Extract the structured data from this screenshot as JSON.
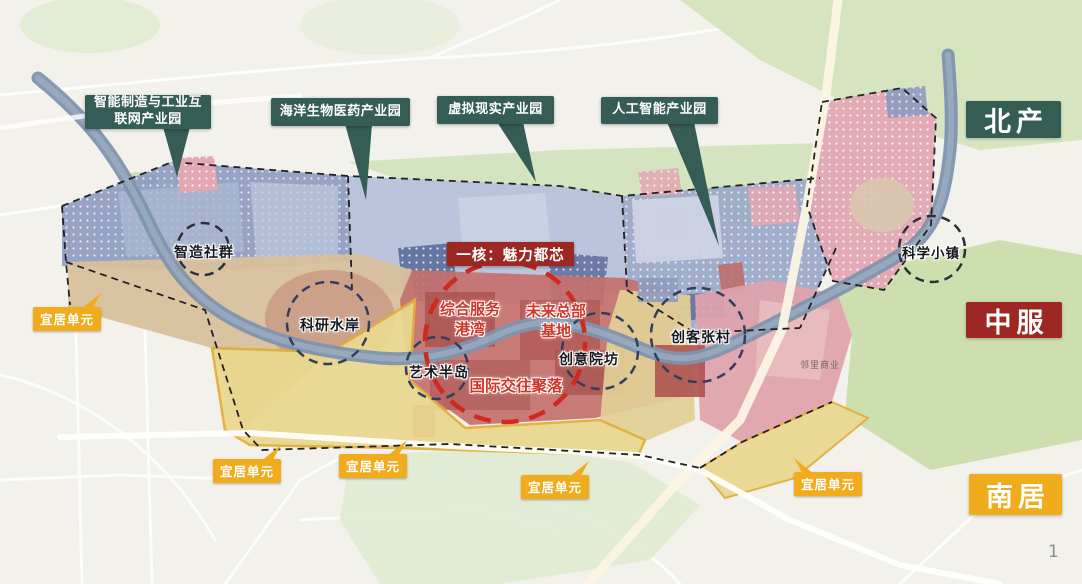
{
  "regions": {
    "north": "北产",
    "central": "中服",
    "south": "南居"
  },
  "callouts": [
    {
      "id": "smart-manufacturing",
      "label": "智能制造与工业互\n联网产业园"
    },
    {
      "id": "marine-biomedicine",
      "label": "海洋生物医药产业园"
    },
    {
      "id": "virtual-reality",
      "label": "虚拟现实产业园"
    },
    {
      "id": "artificial-intelligence",
      "label": "人工智能产业园"
    }
  ],
  "core": {
    "title": "一核：魅力都芯",
    "labels": [
      {
        "id": "service-harbor",
        "text": "综合服务\n港湾"
      },
      {
        "id": "future-headquarters",
        "text": "未来总部\n基地"
      },
      {
        "id": "international-exchange",
        "text": "国际交往聚落"
      }
    ]
  },
  "nodes": [
    {
      "id": "smart-community",
      "label": "智造社群"
    },
    {
      "id": "research-waterfront",
      "label": "科研水岸"
    },
    {
      "id": "art-peninsula",
      "label": "艺术半岛"
    },
    {
      "id": "creative-courtyard",
      "label": "创意院坊"
    },
    {
      "id": "maker-zhang-village",
      "label": "创客张村"
    },
    {
      "id": "science-town",
      "label": "科学小镇"
    }
  ],
  "livable_unit_label": "宜居单元",
  "livable_unit_count": 5,
  "annotations": {
    "neighborhood_commerce": "邻里商业"
  },
  "page_number": "1",
  "colors": {
    "callout_bg": "#355c55",
    "core_red_bg": "#9d2723",
    "accent_red_text": "#d13428",
    "livable_yellow": "#f0ac1c",
    "map_background": "#f2f1ec",
    "river": "#7e93ad",
    "zone_blue": "#8e9cc0",
    "zone_periwinkle": "#b7c1db",
    "zone_pink": "#e2a7b3",
    "zone_core_red": "#c4706c",
    "zone_tan": "#d8c09c",
    "zone_yellow": "#ead88e",
    "zone_green": "#cfe0b8",
    "node_circle_stroke": "#2f3f5c",
    "core_circle_stroke": "#ce2a1e"
  }
}
